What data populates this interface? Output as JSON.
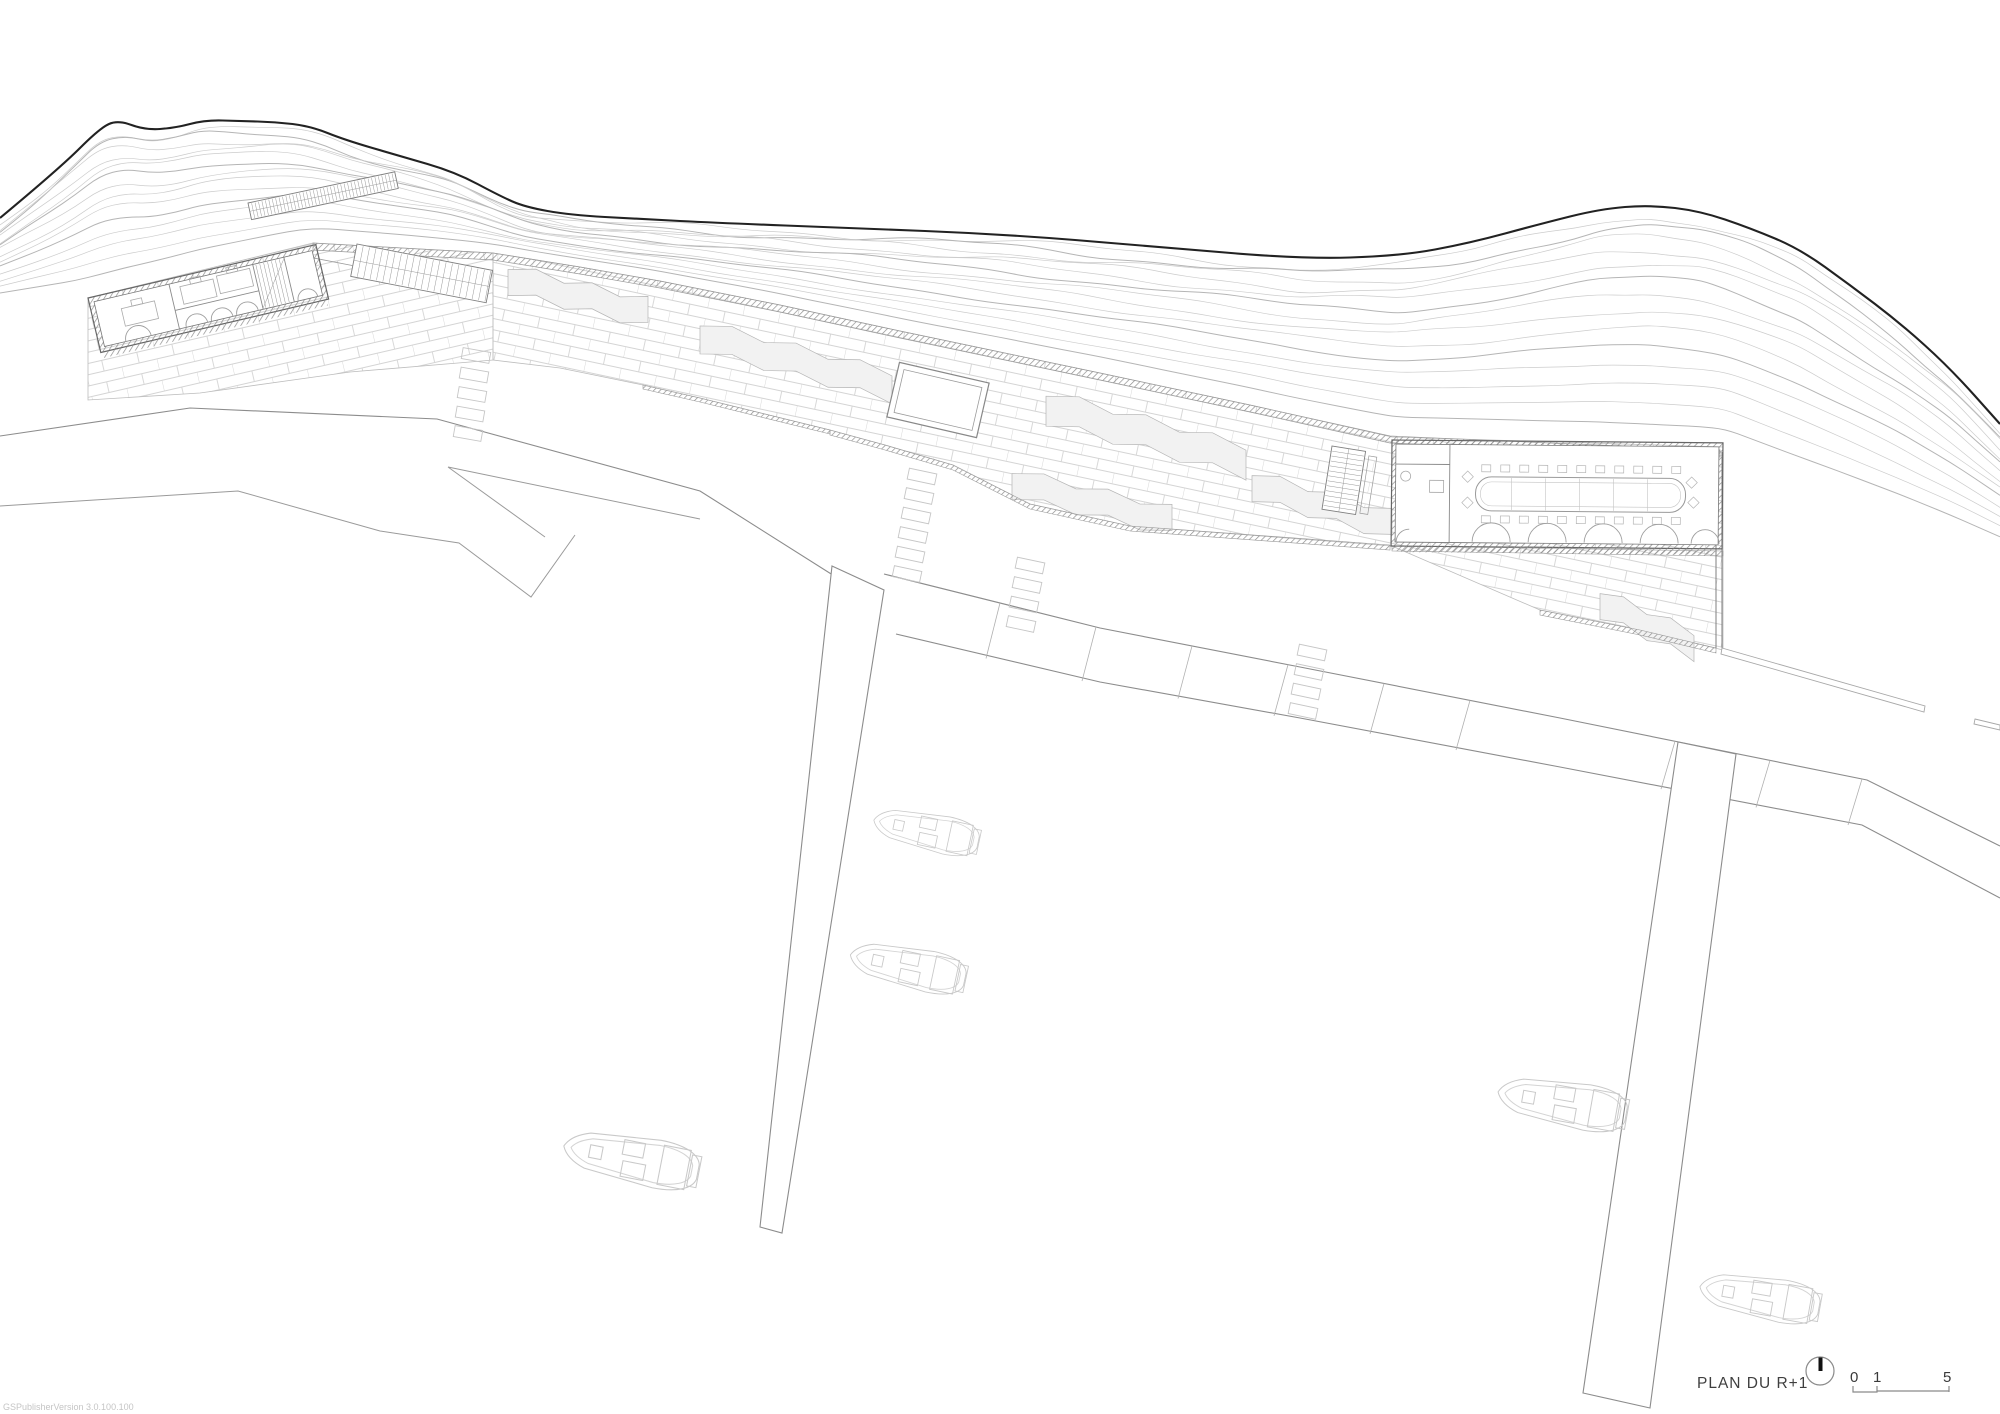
{
  "document": {
    "kind": "architectural site plan drawing",
    "background": "#ffffff"
  },
  "annotations": {
    "plan_title": "PLAN DU R+1",
    "scale_bar": {
      "label_start": "0",
      "label_mid": "1",
      "label_end": "5"
    },
    "watermark": "GSPublisherVersion 3.0.100.100"
  },
  "icons": {
    "north_arrow": "north-arrow-icon"
  },
  "scene": {
    "boats_count": 5,
    "piers_count": 2,
    "buildings_count": 2,
    "features": [
      "hill-contours",
      "shoreline",
      "brick-paved-quay",
      "skylight-opening",
      "stairs",
      "conference-hall-building",
      "office-building",
      "harbor-docks"
    ]
  },
  "palette": {
    "shoreline": "#222222",
    "contour": "#cccccc",
    "contour_dark": "#b5b5b5",
    "quay_line": "#8c8c8c",
    "promontory_line": "#9a9a9a",
    "brick_joint": "#d4d4d4",
    "wall_hatch": "#8f8f8f",
    "highlight_fill": "#f2f2f2",
    "highlight_line": "#b5b5b5",
    "boat_line": "#c9c9c9",
    "ghost_dash": "#c6c6c6",
    "text": "#3f3f3f",
    "watermark_text": "#c5c5c5"
  }
}
